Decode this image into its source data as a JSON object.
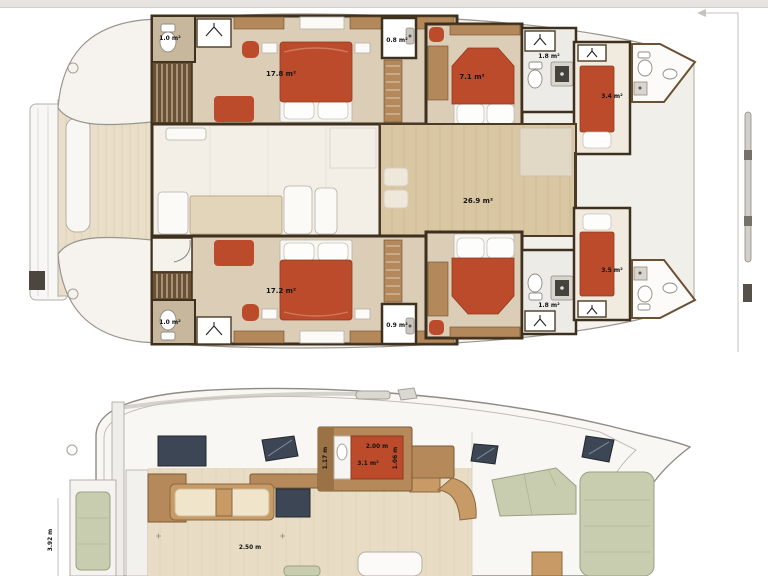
{
  "colors": {
    "bed_red": "#bc4b2b",
    "cushion_green": "#c9cdb0",
    "window_glass": "#3c4654"
  },
  "upper_plan": {
    "labels": {
      "wc_port_aft": "1.0 m²",
      "cabin_port_aft": "17.8 m²",
      "wc_port_mid": "0.8 m²",
      "cabin_port_fwd": "7.1 m²",
      "bath_port_fwd": "1.8 m²",
      "berth_port_bow": "3.4 m²",
      "saloon": "26.9 m²",
      "cabin_stbd_aft": "17.2 m²",
      "wc_stbd_aft": "1.0 m²",
      "wc_stbd_mid": "0.9 m²",
      "bath_stbd_fwd": "1.8 m²",
      "berth_stbd_bow": "3.5 m²"
    }
  },
  "lower_plan": {
    "galley": {
      "width": "2.00 m",
      "area": "3.1 m²",
      "side_left": "1.17 m",
      "side_right": "1.06 m"
    },
    "saloon_width": "2.50 m",
    "cockpit_length": "3.92 m"
  }
}
